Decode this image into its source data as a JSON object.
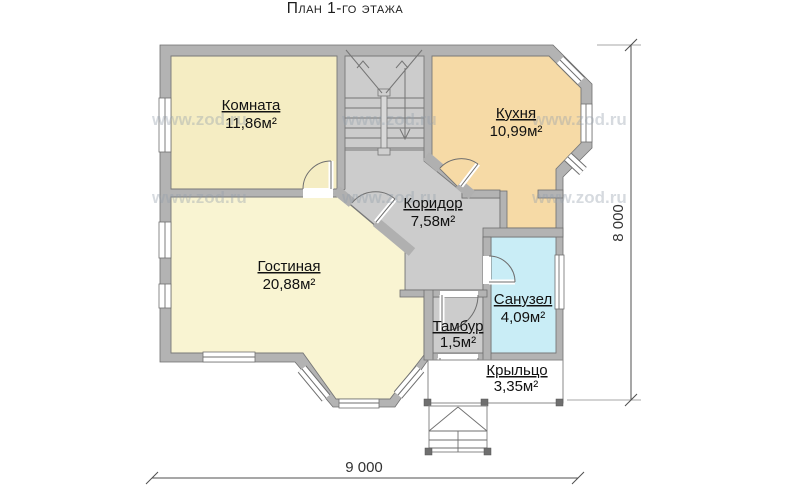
{
  "title": "План 1-го этажа",
  "watermark": "www.zod.ru",
  "rooms": [
    {
      "id": "bedroom",
      "name": "Комната",
      "area": "11,86м²"
    },
    {
      "id": "kitchen",
      "name": "Кухня",
      "area": "10,99м²"
    },
    {
      "id": "corridor",
      "name": "Коридор",
      "area": "7,58м²"
    },
    {
      "id": "living",
      "name": "Гостиная",
      "area": "20,88м²"
    },
    {
      "id": "bathroom",
      "name": "Санузел",
      "area": "4,09м²"
    },
    {
      "id": "vestibule",
      "name": "Тамбур",
      "area": "1,5м²"
    },
    {
      "id": "porch",
      "name": "Крыльцо",
      "area": "3,35м²"
    }
  ],
  "dimensions": {
    "vertical": "8 000",
    "horizontal": "9 000"
  },
  "colors": {
    "bedroom": "#F5EDC3",
    "kitchen": "#F6DAA6",
    "living": "#F9F4D2",
    "bathroom": "#C9EDF6",
    "corridor": "#CCCCCC",
    "wall": "#B3B3B3"
  }
}
